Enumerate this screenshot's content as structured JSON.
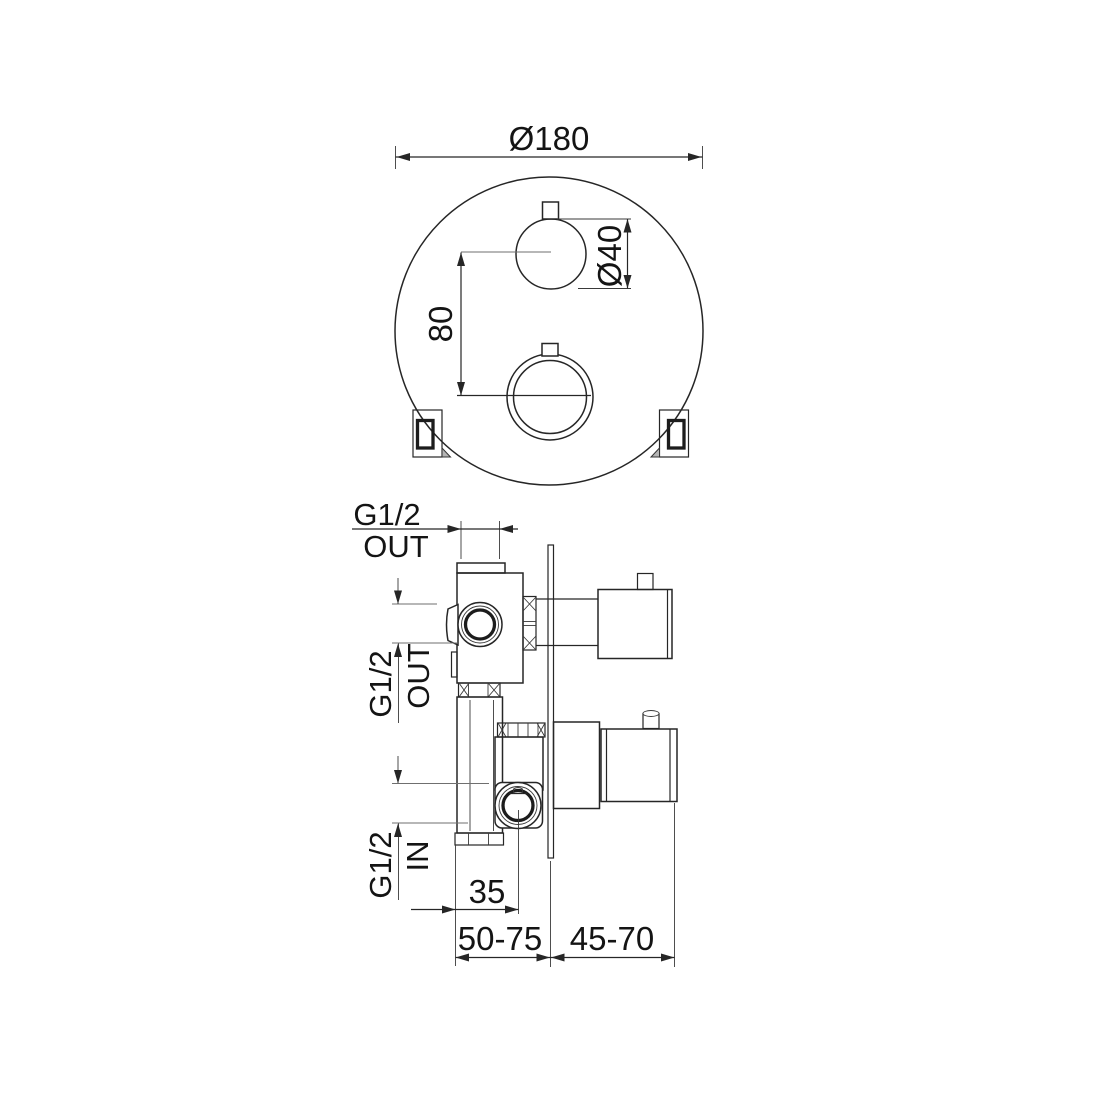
{
  "drawing": {
    "title": "thermostatic-mixer-installation-drawing",
    "background_color": "#ffffff",
    "line_color": "#262626",
    "top_view": {
      "faceplate_diameter": "Ø180",
      "knob_diameter": "Ø40",
      "knob_spacing": "80"
    },
    "section_view": {
      "top_port_thread": "G1/2",
      "top_port_direction": "OUT",
      "side_port_thread": "G1/2",
      "side_port_direction": "OUT",
      "inlet_port_thread": "G1/2",
      "inlet_port_direction": "IN",
      "inlet_offset": "35",
      "install_depth_front": "50-75",
      "install_depth_rear": "45-70"
    }
  }
}
